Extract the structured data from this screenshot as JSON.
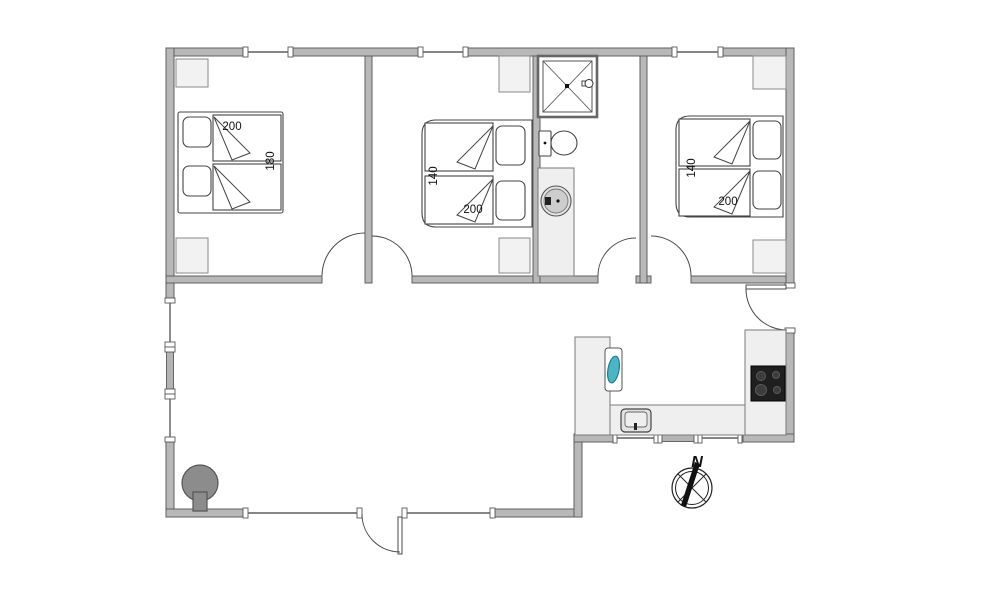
{
  "plan": {
    "type": "holiday-house-floor-plan",
    "bedrooms": [
      {
        "id": "bedroom-1",
        "bed": {
          "length_label": "200",
          "width_label": "180"
        }
      },
      {
        "id": "bedroom-2",
        "bed": {
          "length_label": "200",
          "width_label": "140"
        }
      },
      {
        "id": "bedroom-3",
        "bed": {
          "length_label": "200",
          "width_label": "140"
        }
      }
    ],
    "compass": {
      "north_label": "N"
    },
    "colors": {
      "background": "#ffffff",
      "wall_fill": "#b8b8b8",
      "wall_outline": "#5f5f5f",
      "furniture_fill": "#efefef",
      "wardrobe_fill": "#f2f2f2",
      "sink_accent": "#4ab5c6",
      "cooktop_black": "#1f1f1f",
      "stove_gray": "#8c8c8c"
    }
  }
}
